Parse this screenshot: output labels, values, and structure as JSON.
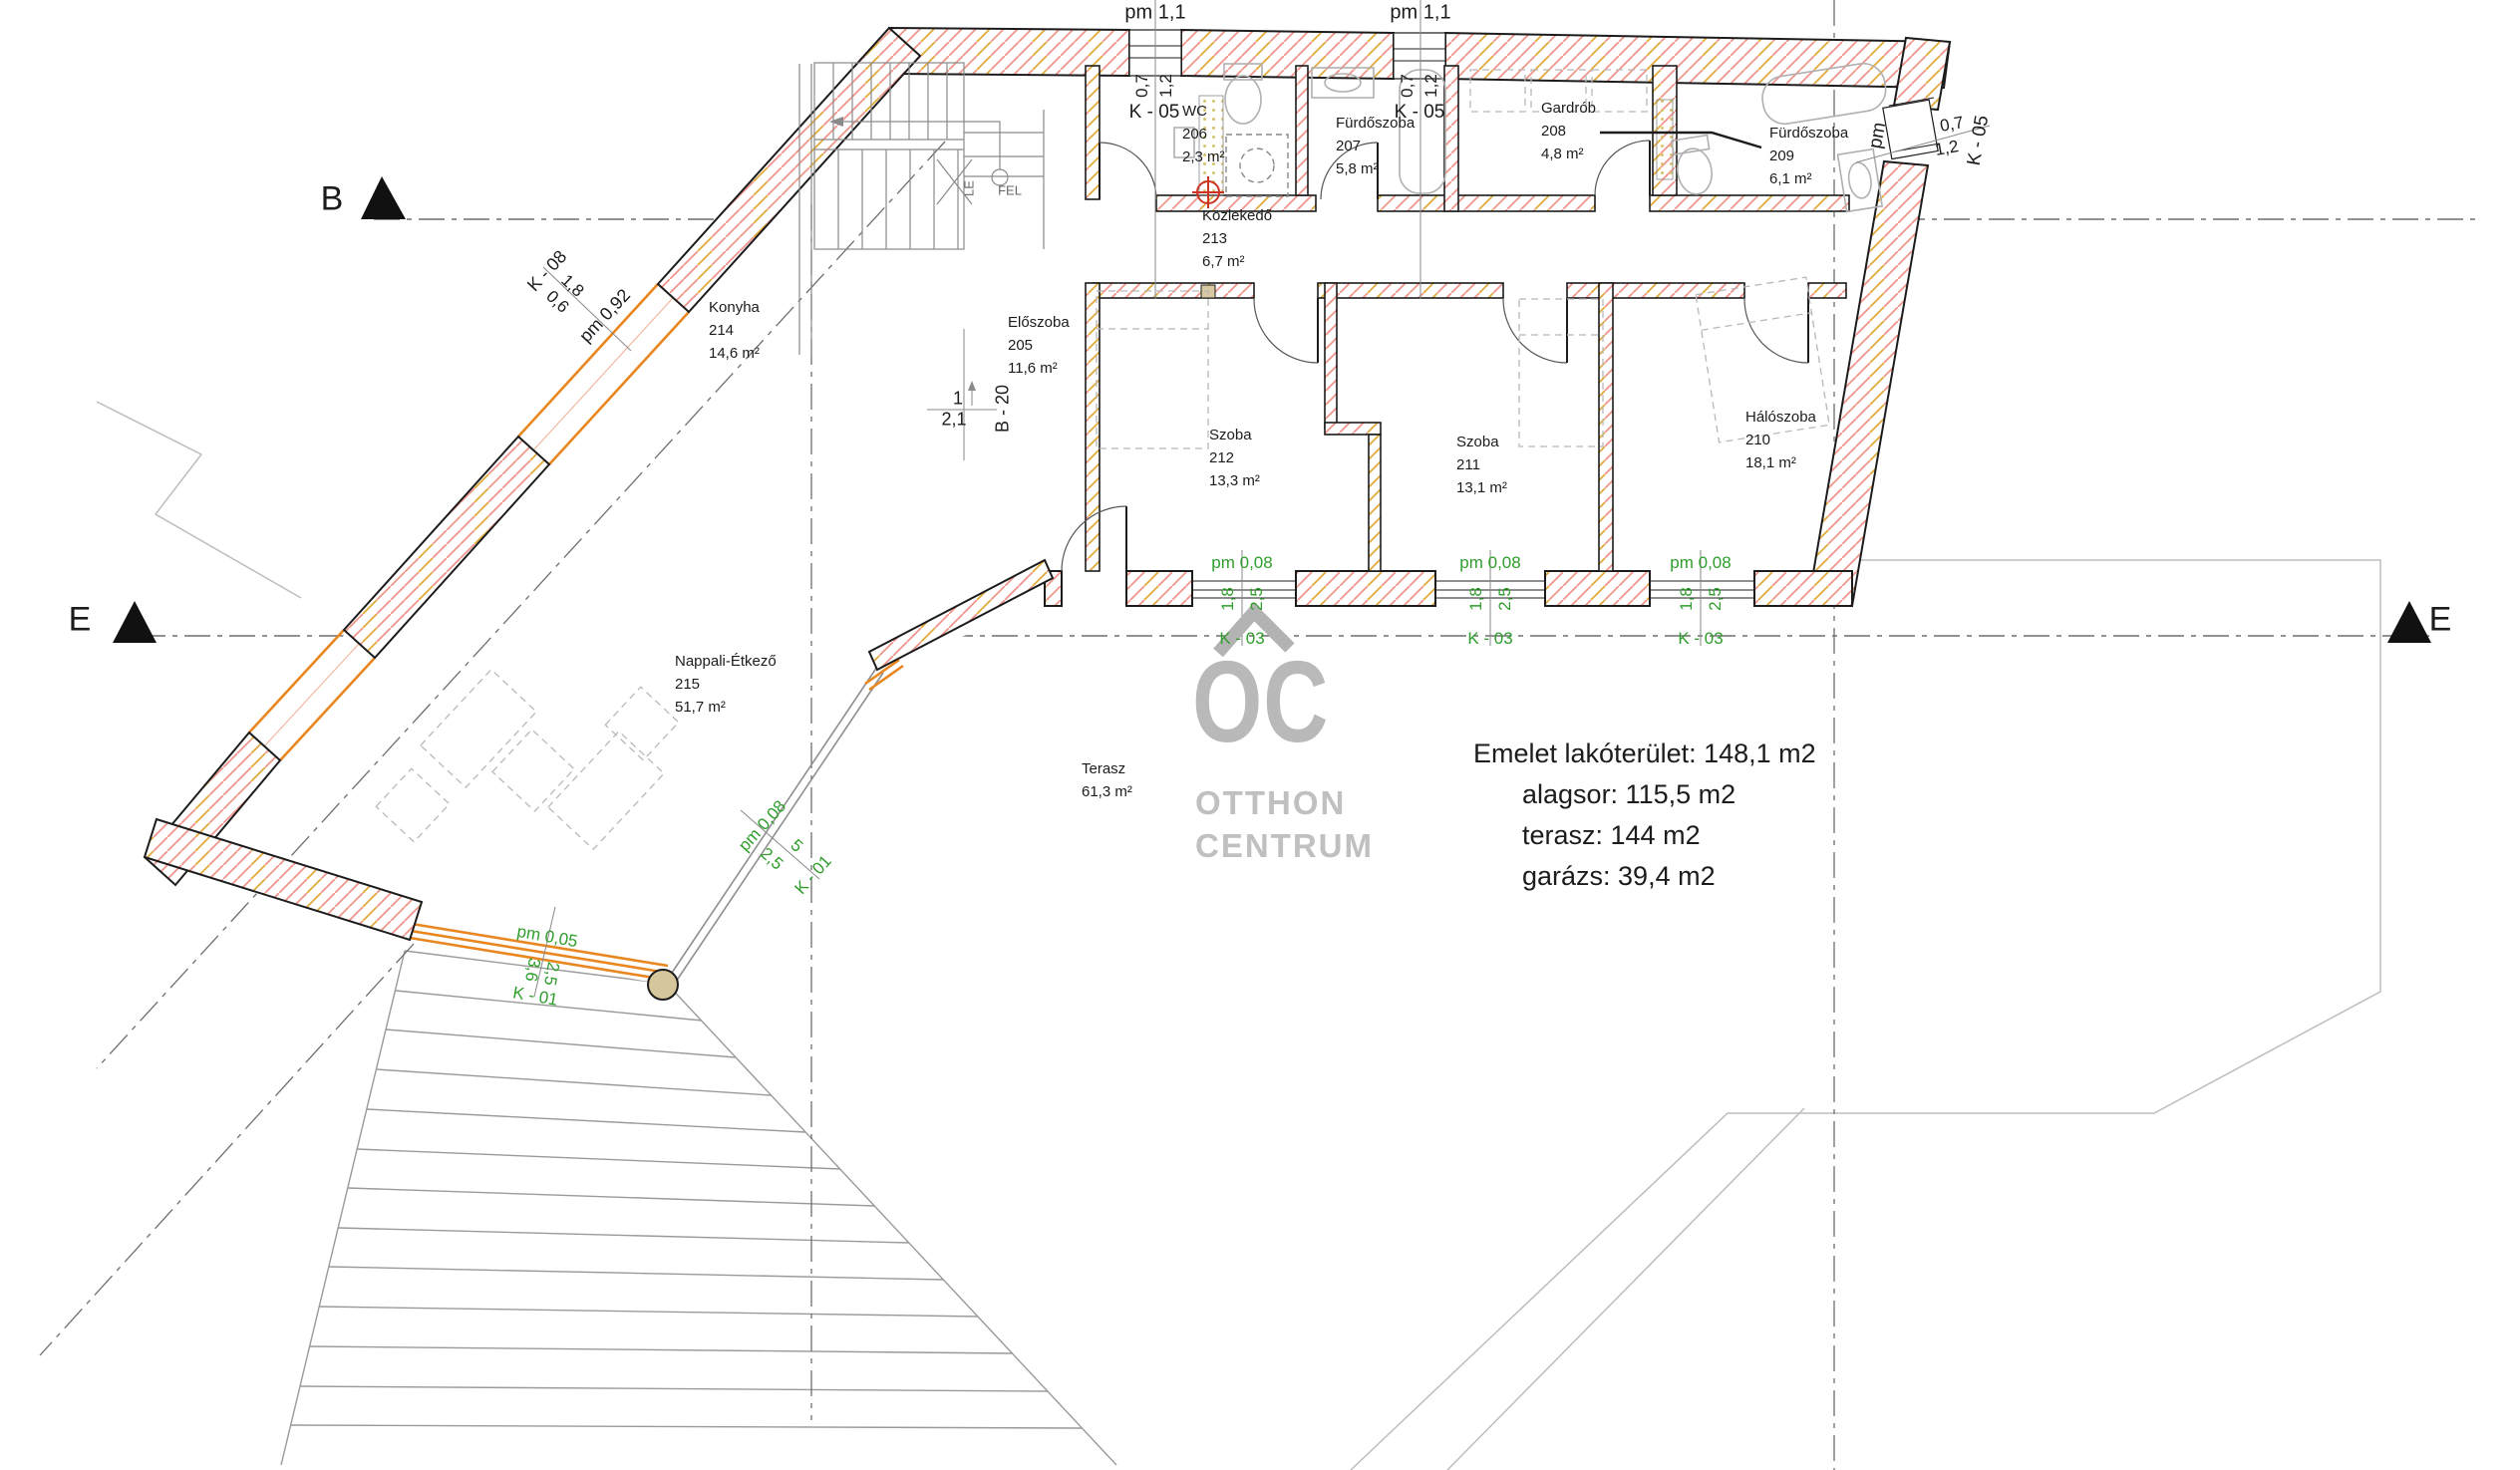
{
  "watermark": {
    "initials": "OC",
    "line1": "OTTHON",
    "line2": "CENTRUM"
  },
  "summary": {
    "line1": "Emelet lakóterület: 148,1 m2",
    "line2": "alagsor: 115,5 m2",
    "line3": "terasz: 144 m2",
    "line4": "garázs: 39,4 m2"
  },
  "sections": {
    "b": "B",
    "e_left": "E",
    "e_right": "E"
  },
  "rooms": [
    {
      "name": "WC",
      "number": "206",
      "area": "2,3 m²"
    },
    {
      "name": "Fürdőszoba",
      "number": "207",
      "area": "5,8 m²"
    },
    {
      "name": "Gardrób",
      "number": "208",
      "area": "4,8 m²"
    },
    {
      "name": "Fürdőszoba",
      "number": "209",
      "area": "6,1 m²"
    },
    {
      "name": "Közlekedő",
      "number": "213",
      "area": "6,7 m²"
    },
    {
      "name": "Előszoba",
      "number": "205",
      "area": "11,6 m²"
    },
    {
      "name": "Szoba",
      "number": "212",
      "area": "13,3 m²"
    },
    {
      "name": "Szoba",
      "number": "211",
      "area": "13,1 m²"
    },
    {
      "name": "Hálószoba",
      "number": "210",
      "area": "18,1 m²"
    },
    {
      "name": "Konyha",
      "number": "214",
      "area": "14,6 m²"
    },
    {
      "name": "Nappali-Étkező",
      "number": "215",
      "area": "51,7 m²"
    },
    {
      "name": "Terasz",
      "number": "",
      "area": "61,3 m²"
    }
  ],
  "markers": {
    "pm11": "pm 1,1",
    "k05": {
      "code": "K - 05",
      "w": "0,7",
      "h": "1,2",
      "pm": "pm"
    },
    "k08": {
      "code": "K - 08",
      "w": "1,8",
      "h": "0,6",
      "pm": "pm 0,92"
    },
    "k03": {
      "code": "K - 03",
      "w": "1,8",
      "h": "2,5",
      "pm": "pm 0,08"
    },
    "k01_terrace": {
      "code": "K - 01",
      "w": "2,5",
      "h": "5",
      "pm": "pm 0,08"
    },
    "k01_lower": {
      "code": "K - 01",
      "w": "3,6",
      "h": "2,5",
      "pm": "pm 0,05"
    },
    "b20": {
      "code": "B - 20",
      "count": "1",
      "dim": "2,1"
    }
  },
  "stairs": {
    "up": "FEL",
    "down": "LE"
  },
  "colors": {
    "wall_hatch_red": "#f0958c",
    "wall_hatch_orange": "#e2aa3c",
    "window_orange": "#e8861f",
    "marker_green": "#2f9e2c",
    "logo_gray": "#b9b9b9",
    "drain_red": "#cc3322"
  }
}
